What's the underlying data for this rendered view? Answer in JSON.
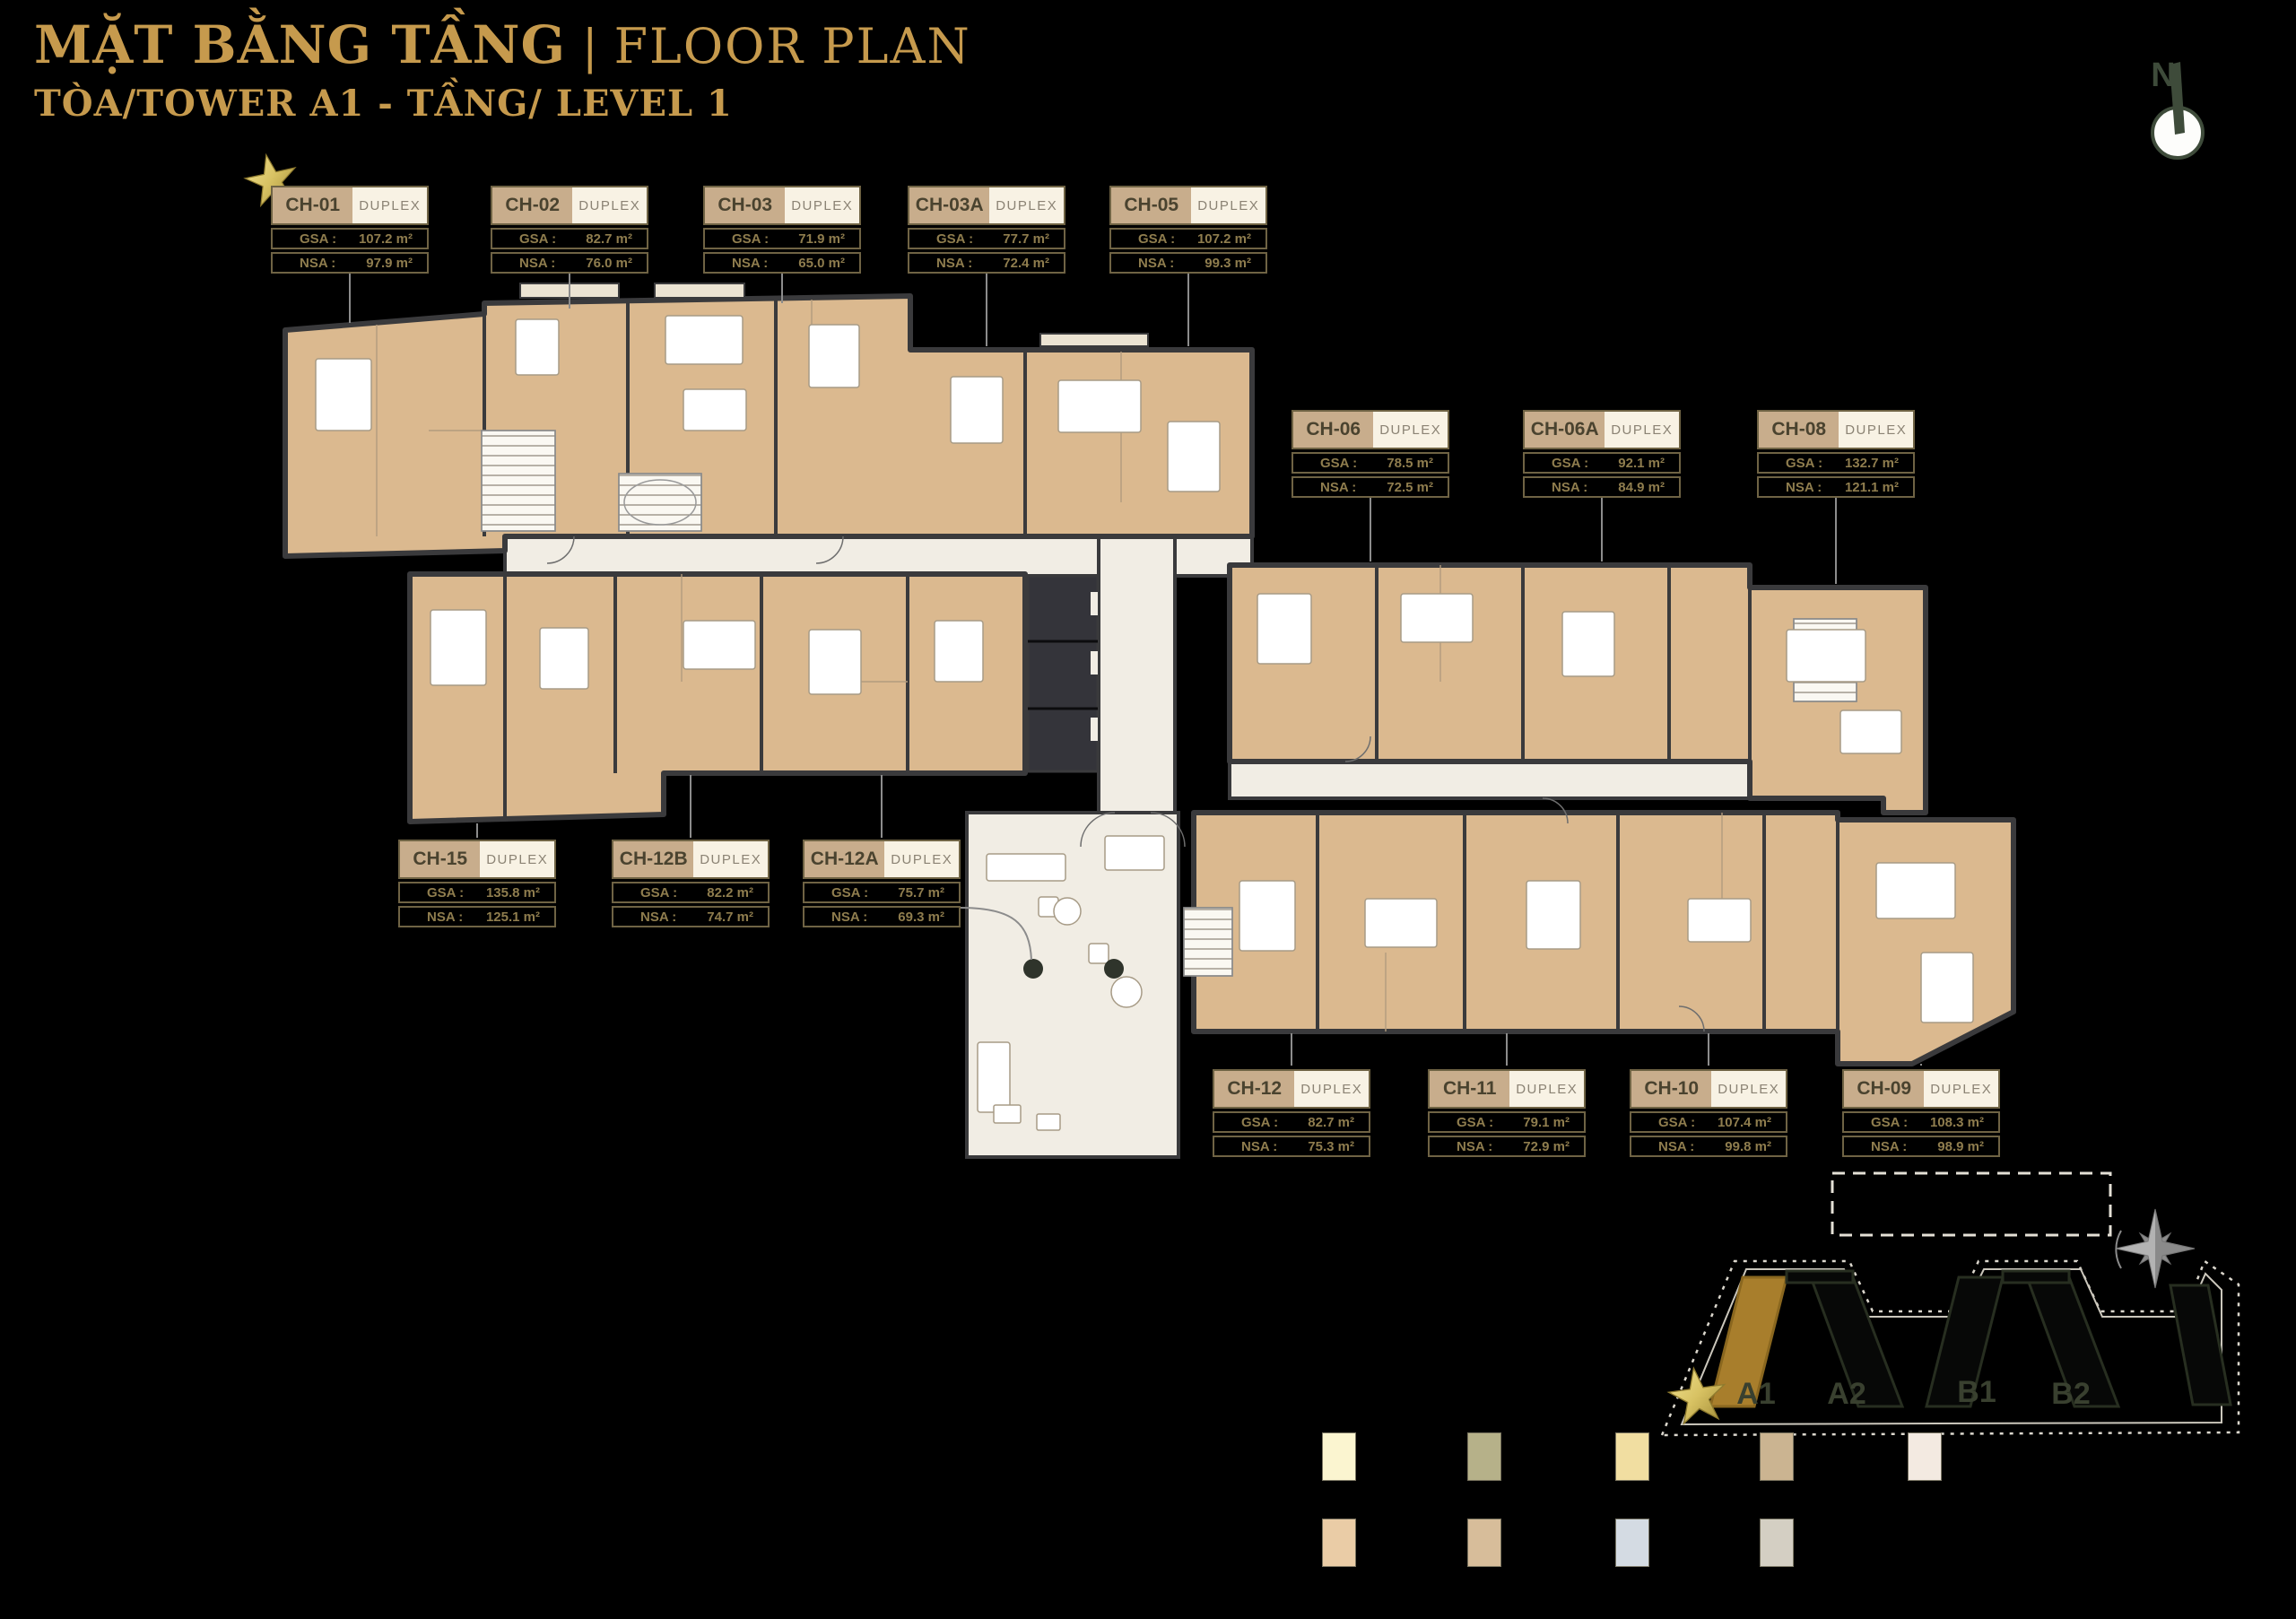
{
  "header": {
    "title_vi": "MẶT BẰNG TẦNG",
    "title_divider": "|",
    "title_en": "FLOOR PLAN",
    "subtitle": "TÒA/TOWER A1 - TẦNG/ LEVEL 1"
  },
  "compass": {
    "label": "N"
  },
  "units": [
    {
      "id": "CH-01",
      "type": "DUPLEX",
      "gsa_label": "GSA :",
      "gsa": "107.2 m²",
      "nsa_label": "NSA :",
      "nsa": "97.9 m²",
      "starred": true
    },
    {
      "id": "CH-02",
      "type": "DUPLEX",
      "gsa_label": "GSA :",
      "gsa": "82.7 m²",
      "nsa_label": "NSA :",
      "nsa": "76.0 m²",
      "starred": false
    },
    {
      "id": "CH-03",
      "type": "DUPLEX",
      "gsa_label": "GSA :",
      "gsa": "71.9 m²",
      "nsa_label": "NSA :",
      "nsa": "65.0 m²",
      "starred": false
    },
    {
      "id": "CH-03A",
      "type": "DUPLEX",
      "gsa_label": "GSA :",
      "gsa": "77.7 m²",
      "nsa_label": "NSA :",
      "nsa": "72.4 m²",
      "starred": false
    },
    {
      "id": "CH-05",
      "type": "DUPLEX",
      "gsa_label": "GSA :",
      "gsa": "107.2 m²",
      "nsa_label": "NSA :",
      "nsa": "99.3 m²",
      "starred": false
    },
    {
      "id": "CH-06",
      "type": "DUPLEX",
      "gsa_label": "GSA :",
      "gsa": "78.5 m²",
      "nsa_label": "NSA :",
      "nsa": "72.5 m²",
      "starred": false
    },
    {
      "id": "CH-06A",
      "type": "DUPLEX",
      "gsa_label": "GSA :",
      "gsa": "92.1 m²",
      "nsa_label": "NSA :",
      "nsa": "84.9 m²",
      "starred": false
    },
    {
      "id": "CH-08",
      "type": "DUPLEX",
      "gsa_label": "GSA :",
      "gsa": "132.7 m²",
      "nsa_label": "NSA :",
      "nsa": "121.1 m²",
      "starred": false
    },
    {
      "id": "CH-15",
      "type": "DUPLEX",
      "gsa_label": "GSA :",
      "gsa": "135.8 m²",
      "nsa_label": "NSA :",
      "nsa": "125.1 m²",
      "starred": false
    },
    {
      "id": "CH-12B",
      "type": "DUPLEX",
      "gsa_label": "GSA :",
      "gsa": "82.2 m²",
      "nsa_label": "NSA :",
      "nsa": "74.7 m²",
      "starred": false
    },
    {
      "id": "CH-12A",
      "type": "DUPLEX",
      "gsa_label": "GSA :",
      "gsa": "75.7 m²",
      "nsa_label": "NSA :",
      "nsa": "69.3 m²",
      "starred": false
    },
    {
      "id": "CH-12",
      "type": "DUPLEX",
      "gsa_label": "GSA :",
      "gsa": "82.7 m²",
      "nsa_label": "NSA :",
      "nsa": "75.3 m²",
      "starred": false
    },
    {
      "id": "CH-11",
      "type": "DUPLEX",
      "gsa_label": "GSA :",
      "gsa": "79.1 m²",
      "nsa_label": "NSA :",
      "nsa": "72.9 m²",
      "starred": false
    },
    {
      "id": "CH-10",
      "type": "DUPLEX",
      "gsa_label": "GSA :",
      "gsa": "107.4 m²",
      "nsa_label": "NSA :",
      "nsa": "99.8 m²",
      "starred": false
    },
    {
      "id": "CH-09",
      "type": "DUPLEX",
      "gsa_label": "GSA :",
      "gsa": "108.3 m²",
      "nsa_label": "NSA :",
      "nsa": "98.9 m²",
      "starred": false
    }
  ],
  "site_plan": {
    "towers": [
      {
        "label": "A1",
        "highlighted": true
      },
      {
        "label": "A2",
        "highlighted": false
      },
      {
        "label": "B1",
        "highlighted": false
      },
      {
        "label": "B2",
        "highlighted": false
      }
    ]
  },
  "legend": {
    "row1": [
      "#FBF5D0",
      "#B6B189",
      "#F1DEA1",
      "#CBB491",
      "#F3EAE1"
    ],
    "row2": [
      "#EACCA6",
      "#D7BD9A",
      "#D4DBE3",
      "#D4CFC3"
    ]
  },
  "colors": {
    "accent_gold": "#C69A4D",
    "unit_fill": "#DBB98F",
    "wall": "#3A3A3C",
    "corridor": "#F1EDE4",
    "label_tan": "#C8AD8C",
    "label_cream": "#F8F2E4",
    "label_border": "#6F6344",
    "label_text": "#8F7D4E",
    "tower_highlight": "#A87E2C"
  }
}
